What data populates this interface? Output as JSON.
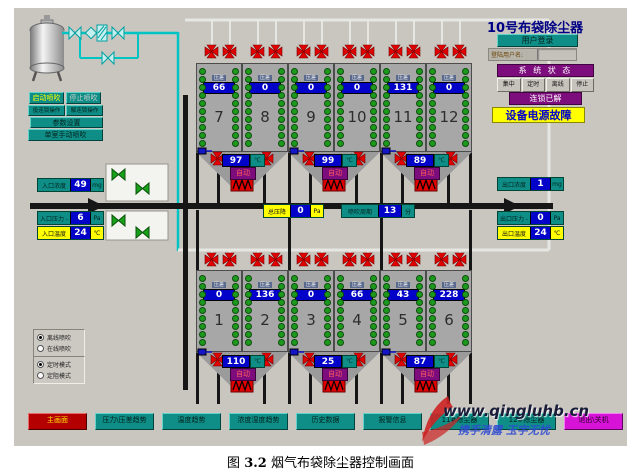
{
  "header_right": {
    "title": "10号布袋除尘器",
    "login_button": "用户登录",
    "username_label": "登陆用户名:",
    "username_value": "",
    "status_header": "系 统 状 态",
    "modes": [
      "集中",
      "定时",
      "离线",
      "停止"
    ],
    "interlock_banner": "连锁已解",
    "alarm_banner": "设备电源故障"
  },
  "controls": {
    "start_blow": "启动喷吹",
    "stop_blow": "停止喷吹",
    "engage_interlock": "投连锁操作",
    "release_interlock": "解连锁操作",
    "param_settings": "参数设置",
    "single_manual_blow": "单室手动喷吹"
  },
  "measurements": {
    "inlet_concentration": {
      "label": "入口浓度",
      "value": "49",
      "unit": "mg"
    },
    "inlet_pressure": {
      "label": "入口压力 -",
      "value": "6",
      "unit": "Pa"
    },
    "inlet_temperature": {
      "label": "入口温度",
      "value": "24",
      "unit": "℃"
    },
    "outlet_concentration": {
      "label": "出口浓度",
      "value": "1",
      "unit": "mg"
    },
    "outlet_pressure": {
      "label": "出口压力 -",
      "value": "0",
      "unit": "Pa"
    },
    "outlet_temperature": {
      "label": "出口温度",
      "value": "24",
      "unit": "℃"
    },
    "total_pressure_drop": {
      "label": "总压降",
      "value": "0",
      "unit": "Pa"
    },
    "blow_cycle": {
      "label": "喷吹周期",
      "value": "13",
      "unit": "分"
    }
  },
  "chambers": {
    "dp_label": "压差",
    "top_row": [
      {
        "no": "7",
        "dp": "66"
      },
      {
        "no": "8",
        "dp": "0"
      },
      {
        "no": "9",
        "dp": "0"
      },
      {
        "no": "10",
        "dp": "0"
      },
      {
        "no": "11",
        "dp": "131"
      },
      {
        "no": "12",
        "dp": "0"
      }
    ],
    "bottom_row": [
      {
        "no": "1",
        "dp": "0"
      },
      {
        "no": "2",
        "dp": "136"
      },
      {
        "no": "3",
        "dp": "0"
      },
      {
        "no": "4",
        "dp": "66"
      },
      {
        "no": "5",
        "dp": "43"
      },
      {
        "no": "6",
        "dp": "228"
      }
    ],
    "top_hoppers": [
      {
        "temp": "97",
        "unit": "℃",
        "mode": "自动"
      },
      {
        "temp": "99",
        "unit": "℃",
        "mode": "自动"
      },
      {
        "temp": "89",
        "unit": "℃",
        "mode": "自动"
      }
    ],
    "bottom_hoppers": [
      {
        "temp": "110",
        "unit": "℃",
        "mode": "自动"
      },
      {
        "temp": "25",
        "unit": "℃",
        "mode": "自动"
      },
      {
        "temp": "87",
        "unit": "℃",
        "mode": "自动"
      }
    ]
  },
  "blow_options": {
    "group1": [
      {
        "label": "离线喷吹",
        "selected": true
      },
      {
        "label": "在线喷吹",
        "selected": false
      }
    ],
    "group2": [
      {
        "label": "定时模式",
        "selected": true
      },
      {
        "label": "定阻模式",
        "selected": false
      }
    ]
  },
  "nav": [
    {
      "label": "主画面"
    },
    {
      "label": "压力\\压差趋势"
    },
    {
      "label": "温度趋势"
    },
    {
      "label": "浓度湿度趋势"
    },
    {
      "label": "历史数据"
    },
    {
      "label": "报警信息"
    },
    {
      "label": "11#除尘器"
    },
    {
      "label": "12#除尘器"
    },
    {
      "label": "退出\\关机"
    }
  ],
  "watermark": {
    "url": "www.qingluhb.cn",
    "slogan": "携手清露 玉宇无忧"
  },
  "caption": {
    "prefix": "图",
    "number": "3.2",
    "text": "烟气布袋除尘器控制画面"
  },
  "colors": {
    "teal": "#0e8e86",
    "value_blue": "#0202c8",
    "alert_yellow": "#ffff00",
    "purple": "#7d0d7d",
    "valve_red": "#e00000",
    "pipe_cyan": "#00c3c3",
    "main_red": "#b40000",
    "magenta": "#d813d8"
  }
}
